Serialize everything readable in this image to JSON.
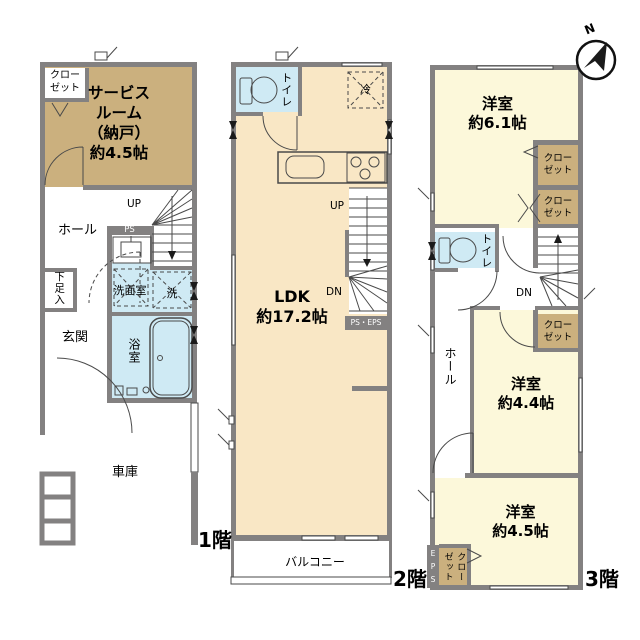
{
  "compass": {
    "north_label": "N"
  },
  "colors": {
    "wall": "#838181",
    "tan": "#cbb07e",
    "peach": "#f9e7c5",
    "yellow": "#fcf8da",
    "blue": "#cfeaf4",
    "line": "#4a4a4a",
    "text": "#000000"
  },
  "floor1": {
    "floor_label": "1階",
    "rooms": {
      "closet": "クロー\nゼット",
      "service_room": "サービス\nルーム\n（納戸）\n約4.5帖",
      "hall": "ホール",
      "up": "UP",
      "ps": "PS",
      "washroom": "洗面室",
      "washer": "洗",
      "shoe_box": "下足入",
      "entrance": "玄関",
      "bathroom": "浴室",
      "garage": "車庫"
    }
  },
  "floor2": {
    "floor_label": "2階",
    "rooms": {
      "toilet": "トイレ",
      "fridge": "冷",
      "up": "UP",
      "down": "DN",
      "ldk": "LDK\n約17.2帖",
      "ps_eps": "PS・EPS",
      "balcony": "バルコニー"
    }
  },
  "floor3": {
    "floor_label": "3階",
    "rooms": {
      "bedroom1": "洋室\n約6.1帖",
      "closet1": "クロー\nゼット",
      "closet2": "クロー\nゼット",
      "toilet": "トイレ",
      "down": "DN",
      "hall": "ホール",
      "closet3": "クロー\nゼット",
      "bedroom2": "洋室\n約4.4帖",
      "bedroom3": "洋室\n約4.5帖",
      "closet4": "クロー\nゼット",
      "eps": "E\nP\nS"
    }
  }
}
